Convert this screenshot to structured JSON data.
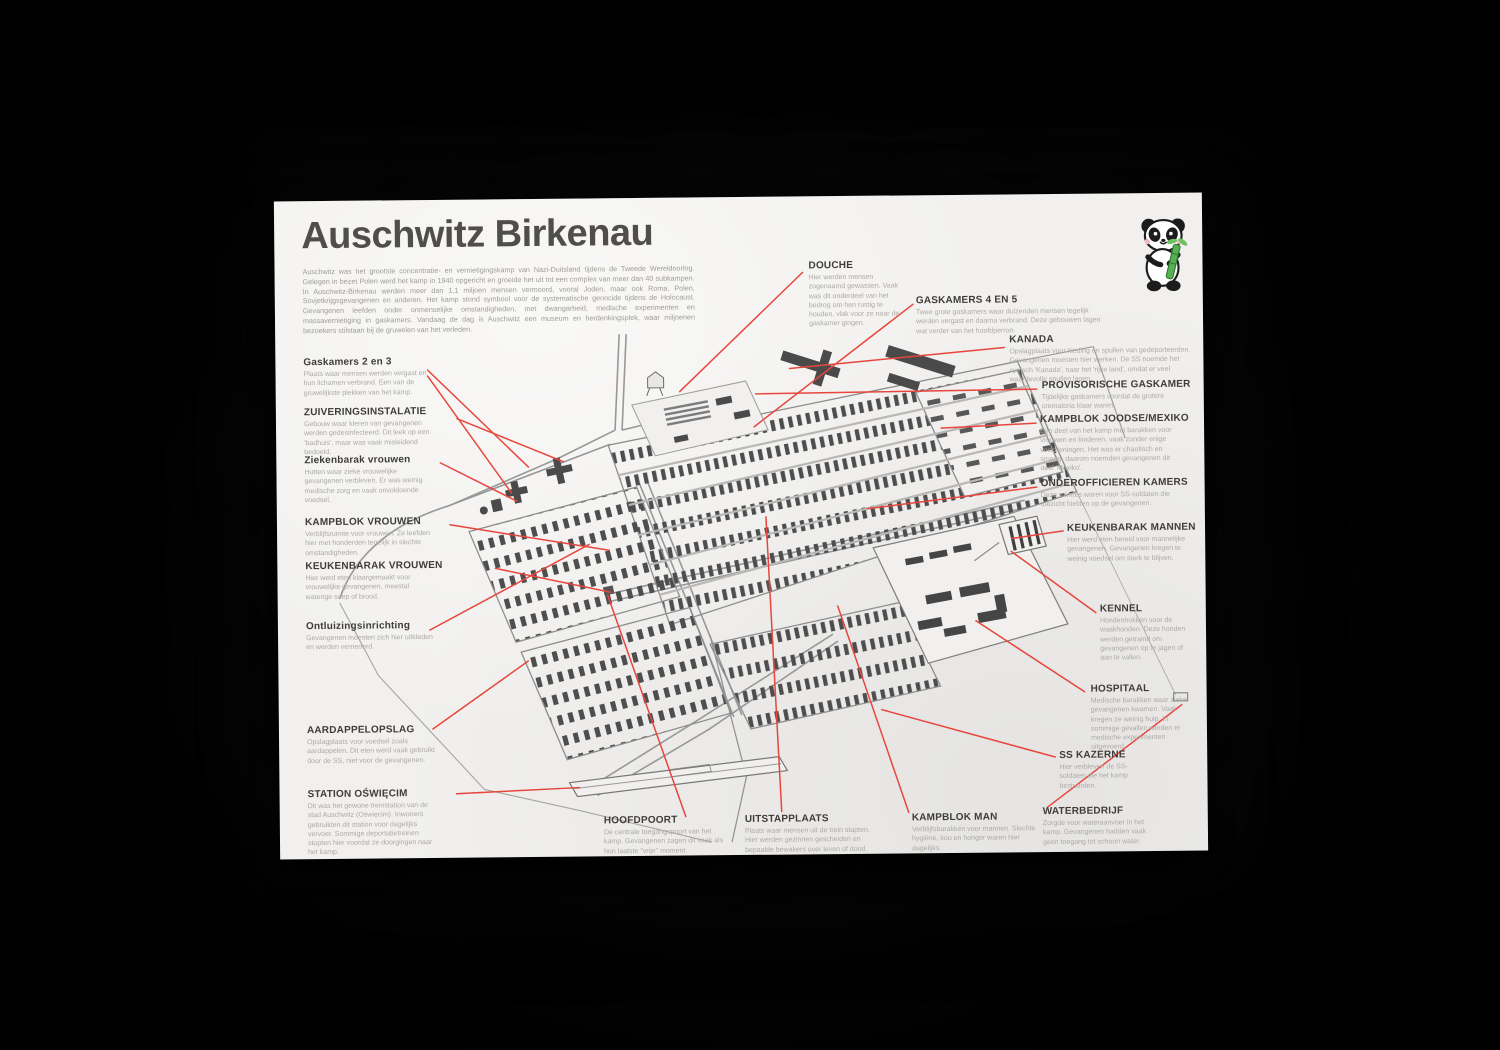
{
  "poster": {
    "title": "Auschwitz Birkenau",
    "intro": "Auschwitz was het grootste concentratie- en vernietigingskamp van Nazi-Duitsland tijdens de Tweede Wereldoorlog. Gelegen in bezet Polen werd het kamp in 1940 opgericht en groeide het uit tot een complex van meer dan 40 subkampen. In Auschwitz-Birkenau werden meer dan 1,1 miljoen mensen vermoord, vooral Joden, maar ook Roma, Polen, Sovjetkrijgsgevangenen en anderen. Het kamp stond symbool voor de systematische genocide tijdens de Holocaust. Gevangenen leefden onder onmenselijke omstandigheden, met dwangarbeid, medische experimenten en massavernietiging in gaskamers. Vandaag de dag is Auschwitz een museum en herdenkingsplek, waar miljoenen bezoekers stilstaan bij de gruwelen van het verleden.",
    "accent_color": "#e8463c",
    "paper_color": "#f1f0ee",
    "logo": "panda-with-bamboo"
  },
  "labels": {
    "left": [
      {
        "title": "Gaskamers 2 en 3",
        "desc": "Plaats waar mensen werden vergast en hun lichamen verbrand. Een van de gruwelijkste plekken van het kamp."
      },
      {
        "title": "ZUIVERINGSINSTALATIE",
        "desc": "Gebouw waar kleren van gevangenen werden gedesinfecteerd. Dit leek op een 'badhuis', maar was vaak misleidend bedoeld."
      },
      {
        "title": "Ziekenbarak vrouwen",
        "desc": "Hutten waar zieke vrouwelijke gevangenen verbleven. Er was weinig medische zorg en vaak onvoldoende voedsel."
      },
      {
        "title": "KAMPBLOK VROUWEN",
        "desc": "Verblijfsruimte voor vrouwen. Ze leefden hier met honderden tegelijk in slechte omstandigheden."
      },
      {
        "title": "KEUKENBARAK VROUWEN",
        "desc": "Hier werd eten klaargemaakt voor vrouwelijke gevangenen, meestal waterige soep of brood."
      },
      {
        "title": "Ontluizingsinrichting",
        "desc": "Gevangenen moesten zich hier uitkleden en werden vernederd."
      },
      {
        "title": "AARDAPPELOPSLAG",
        "desc": "Opslagplaats voor voedsel zoals aardappelen. Dit eten werd vaak gebruikt door de SS, niet voor de gevangenen."
      },
      {
        "title": "STATION OŚWIĘCIM",
        "desc": "Dit was het gewone treinstation van de stad Auschwitz (Oświęcim). Inwoners gebruikten dit station voor dagelijks vervoer. Sommige deportatietreinen stopten hier voordat ze doorgingen naar het kamp."
      }
    ],
    "top": [
      {
        "title": "DOUCHE",
        "desc": "Hier werden mensen zogenaamd gewassen. Vaak was dit onderdeel van het bedrog om hen rustig te houden, vlak voor ze naar de gaskamer gingen."
      },
      {
        "title": "GASKAMERS 4 EN 5",
        "desc": "Twee grote gaskamers waar duizenden mensen tegelijk werden vergast en daarna verbrand. Deze gebouwen lagen wat verder van het hoofdperron."
      },
      {
        "title": "KANADA",
        "desc": "Opslagplaats voor kleding en spullen van gedeporteerden. Gevangenen moesten hier werken. De SS noemde het cynisch 'Kanada', naar het 'rijke land', omdat er veel waardevolle spullen lagen."
      }
    ],
    "right": [
      {
        "title": "PROVISORISCHE GASKAMER",
        "desc": "Tijdelijke gaskamers voordat de grotere crematoria klaar waren."
      },
      {
        "title": "KAMPBLOK JOODSE/MEXIKO",
        "desc": "Een deel van het kamp met barakken voor vrouwen en kinderen, vaak zonder enige voorzieningen. Het was er chaotisch en smerig, daarom noemden gevangenen dit deel 'Mexiko'."
      },
      {
        "title": "ONDEROFFICIEREN KAMERS",
        "desc": "Deze ruimtes waren voor SS-soldaten die toezicht hielden op de gevangenen."
      },
      {
        "title": "KEUKENBARAK MANNEN",
        "desc": "Hier werd eten bereid voor mannelijke gevangenen. Gevangenen kregen te weinig voedsel om sterk te blijven."
      },
      {
        "title": "KENNEL",
        "desc": "Hondenhokken voor de waakhonden. Deze honden werden getraind om gevangenen op te jagen of aan te vallen."
      },
      {
        "title": "HOSPITAAL",
        "desc": "Medische barakken waar zieke gevangenen kwamen. Vaak kregen ze weinig hulp. In sommige gevallen werden er medische experimenten uitgevoerd."
      },
      {
        "title": "SS KAZERNE",
        "desc": "Hier verbleven de SS-soldaten die het kamp bestuurden."
      },
      {
        "title": "WATERBEDRIJF",
        "desc": "Zorgde voor wateraanvoer in het kamp. Gevangenen hadden vaak geen toegang tot schoon water."
      }
    ],
    "bottom": [
      {
        "title": "HOOFDPOORT",
        "desc": "De centrale toegangspoort van het kamp. Gevangenen zagen dit vaak als hun laatste \"vrije\" moment."
      },
      {
        "title": "UITSTAPPLAATS",
        "desc": "Plaats waar mensen uit de trein stapten. Hier werden gezinnen gescheiden en bepaalde bewakers over leven of dood."
      },
      {
        "title": "KAMPBLOK MAN",
        "desc": "Verblijfsbarakken voor mannen. Slechte hygiëne, kou en honger waren hier dagelijks."
      }
    ]
  }
}
